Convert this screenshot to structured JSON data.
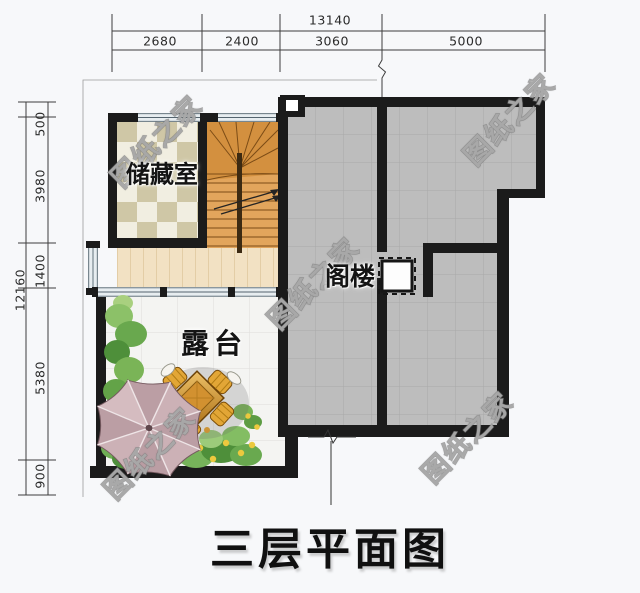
{
  "title": "三层平面图",
  "watermark": {
    "text": "图纸之家"
  },
  "rooms": {
    "storage": "储藏室",
    "attic": "阁楼",
    "terrace": "露台"
  },
  "dimensions": {
    "top": {
      "total": "13140",
      "segments": [
        "2680",
        "2400",
        "3060",
        "5000"
      ]
    },
    "left": {
      "total": "12160",
      "segments": [
        "500",
        "3980",
        "1400",
        "5380",
        "900"
      ]
    }
  },
  "colors": {
    "background": "#f7f8fa",
    "wall": "#1b1b1b",
    "attic_floor": "#bdbdbd",
    "terrace_tile": "#f4f4f2",
    "hall_wood": "#f2e1c3",
    "checker_dark": "#cfc7a6",
    "checker_light": "#f1eee1",
    "stair_wood": "#e2a55c",
    "window_fill": "#e7edf0",
    "plant_green": "#69a84e",
    "umbrella": "#ccb1b6",
    "furniture_gold": "#e2a636"
  }
}
